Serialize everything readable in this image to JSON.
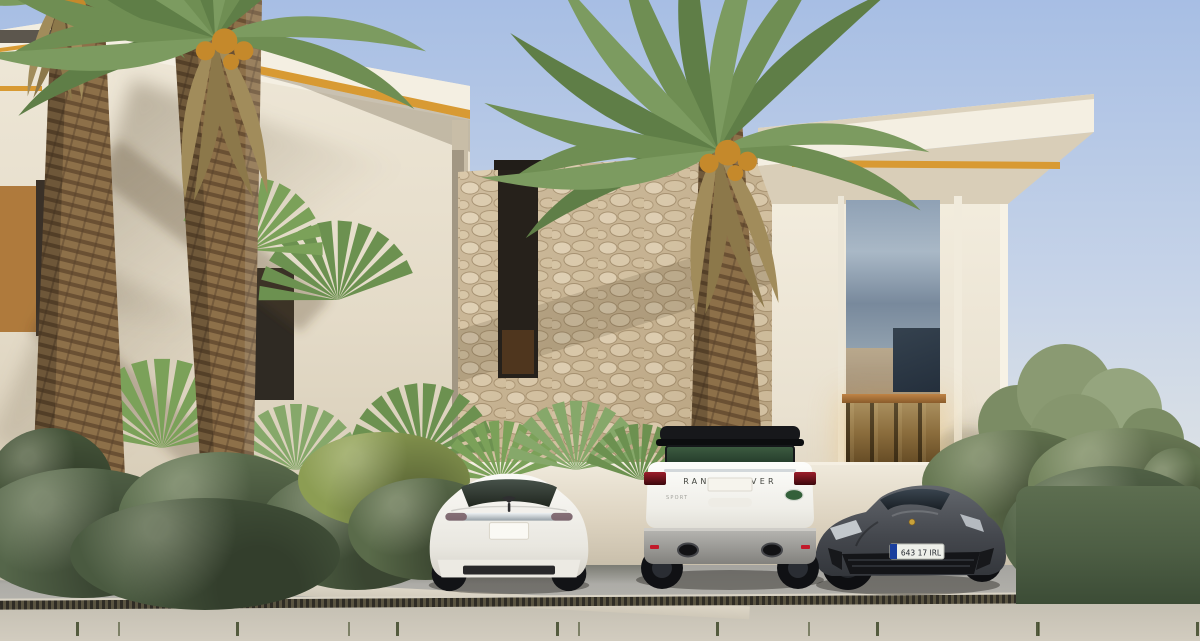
{
  "image": {
    "type": "architectural-exterior-render",
    "subject": "Modern cream villa with stone feature wall, palm trees and three cars parked on the driveway"
  },
  "vehicles": {
    "tesla": {
      "badge": "tesla-logo-icon",
      "body_color": "#f1efe9",
      "license_plate": ""
    },
    "range_rover": {
      "tailgate_label": "RANGE ROVER",
      "sport_badge": "SPORT",
      "badge": "land-rover-badge-icon",
      "body_color": "#f5f4f0",
      "roof_color": "#17181b"
    },
    "porsche": {
      "crest": "porsche-crest-icon",
      "license_plate": "643 17 IRL",
      "body_color": "#4b4e53",
      "caliper_color": "#d4b41c",
      "plate_band_color": "#1a3f9e"
    }
  },
  "palette": {
    "sky-top": "#a7bee4",
    "sky-mid": "#c7d4e8",
    "sky-low": "#e0e4e5",
    "wall-cream": "#e9e2d2",
    "wall-cream-dark": "#d7ccb7",
    "stone": "#c9b697",
    "roof-gold": "#d89a33",
    "glass-dark": "#26211b",
    "hedge-green": "#55664a",
    "palm-green": "#6f8e53",
    "palm-dry": "#a18c5b",
    "trunk-brown": "#8d7049",
    "drive-fore": "#cdc7ba",
    "drive-back": "#a7a6a2",
    "drain": "#3b382f",
    "fruit-gold": "#c5892b",
    "tail-red": "#9c1f2b",
    "plate-blue": "#1a3f9e",
    "caliper-yellow": "#d4b41c"
  }
}
